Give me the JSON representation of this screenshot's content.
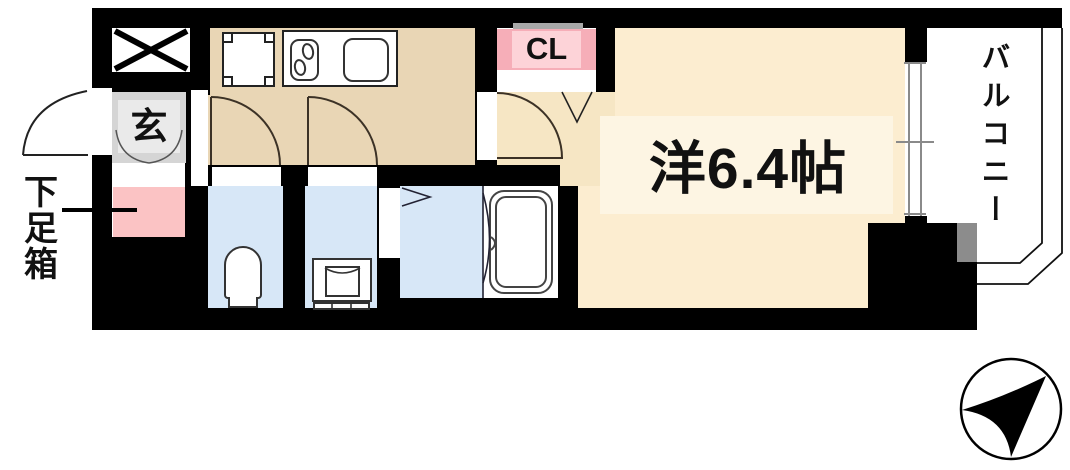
{
  "floorplan": {
    "entrance_label": "玄",
    "shoebox_label": "下足箱",
    "closet_label": "CL",
    "main_room_label": "洋6.4帖",
    "balcony_label": "バルコニー"
  },
  "icons": {
    "elevator_shaft": "x-box-icon",
    "north_arrow": "compass-icon"
  },
  "colors": {
    "wall": "#000000",
    "kitchen": "#e9d6b5",
    "room": "#fcedd0",
    "room-inner": "#fdf5e3",
    "hallway": "#f6e6c4",
    "wet-blue": "#d7e7f7",
    "shoebox-pink": "#fbc3c4",
    "cl-pink-dark": "#f6aeb8",
    "cl-pink-light": "#fdd3d8",
    "cl-gray": "#a8a8a8",
    "entrance-gray": "#d5d5d5",
    "entrance-gray-inner": "#eaeaea",
    "pillar-gray": "#8c8c8c",
    "window-gray": "#8a8a8a",
    "line": "#2b2b2b"
  }
}
